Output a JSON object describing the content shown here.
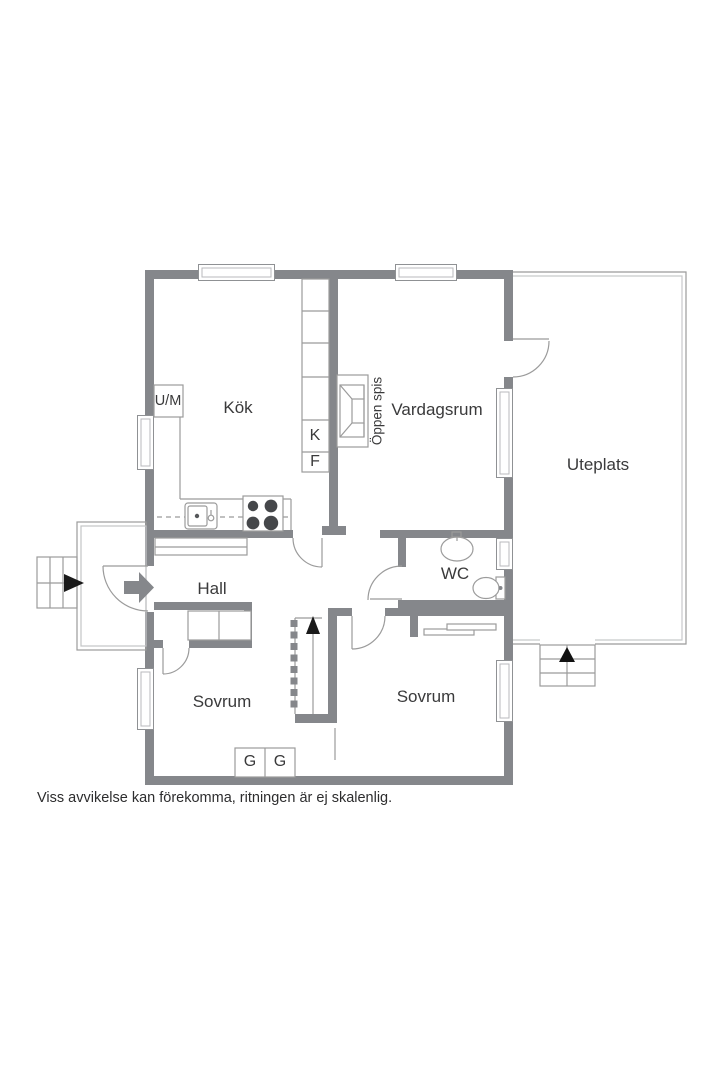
{
  "plan": {
    "caption": "Viss avvikelse kan förekomma, ritningen är ej skalenlig.",
    "rooms": {
      "kitchen": "Kök",
      "living_room": "Vardagsrum",
      "patio": "Uteplats",
      "hall": "Hall",
      "wc": "WC",
      "bedroom_left": "Sovrum",
      "bedroom_right": "Sovrum",
      "fireplace": "Öppen spis"
    },
    "labels": {
      "washer": "U/M",
      "fridge": "K",
      "freezer": "F",
      "wardrobes": [
        "G",
        "G"
      ]
    },
    "colors": {
      "wall": "#85878b",
      "thin_line": "#9b9b9b",
      "text": "#3a3a3b"
    }
  }
}
